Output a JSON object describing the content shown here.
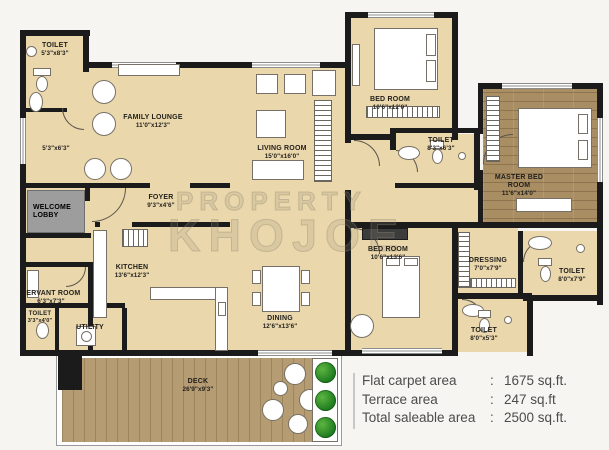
{
  "watermark": {
    "line1": "PROPERTY",
    "line2": "KHOJOE"
  },
  "rooms": {
    "toilet_top_left": {
      "name": "TOILET",
      "dims": "5'3\"x8'3\""
    },
    "lounge_alcove": {
      "dims": "5'3\"x6'3\""
    },
    "family_lounge": {
      "name": "FAMILY LOUNGE",
      "dims": "11'0\"x12'3\""
    },
    "living_room": {
      "name": "LIVING ROOM",
      "dims": "15'0\"x16'0\""
    },
    "bedroom_top": {
      "name": "BED ROOM",
      "dims": "10'6\"x12'0\""
    },
    "toilet_mid": {
      "name": "TOILET",
      "dims": "8'3\"x6'3\""
    },
    "master_bedroom": {
      "name": "MASTER BED ROOM",
      "dims": "11'6\"x14'0\""
    },
    "welcome_lobby": {
      "name": "WELCOME LOBBY"
    },
    "foyer": {
      "name": "FOYER",
      "dims": "9'3\"x4'6\""
    },
    "kitchen": {
      "name": "KITCHEN",
      "dims": "13'6\"x12'3\""
    },
    "servant_room": {
      "name": "SERVANT ROOM",
      "dims": "6'3\"x7'3\""
    },
    "toilet_servant": {
      "name": "TOILET",
      "dims": "3'3\"x4'0\""
    },
    "utility": {
      "name": "UTILITY"
    },
    "dining": {
      "name": "DINING",
      "dims": "12'6\"x13'6\""
    },
    "bedroom_bottom": {
      "name": "BED ROOM",
      "dims": "10'6\"x13'6\""
    },
    "dressing": {
      "name": "DRESSING",
      "dims": "7'0\"x7'9\""
    },
    "toilet_right": {
      "name": "TOILET",
      "dims": "8'0\"x7'9\""
    },
    "toilet_bottom_right": {
      "name": "TOILET",
      "dims": "8'0\"x5'3\""
    },
    "deck": {
      "name": "DECK",
      "dims": "26'9\"x9'3\""
    }
  },
  "area_summary": {
    "rows": [
      {
        "label": "Flat carpet area",
        "sep": ":",
        "value": "1675 sq.ft."
      },
      {
        "label": "Terrace area",
        "sep": ":",
        "value": "247 sq.ft"
      },
      {
        "label": "Total saleable area",
        "sep": ":",
        "value": "2500 sq.ft."
      }
    ]
  },
  "colors": {
    "room_fill": "#ead7ab",
    "wall": "#1b1b1b",
    "master_wood": "#a98e63",
    "deck_wood": "#b59c73",
    "lobby_gray": "#9d9d9d",
    "plant_green": "#2f9e2f",
    "summary_text": "#4c4c4c"
  }
}
